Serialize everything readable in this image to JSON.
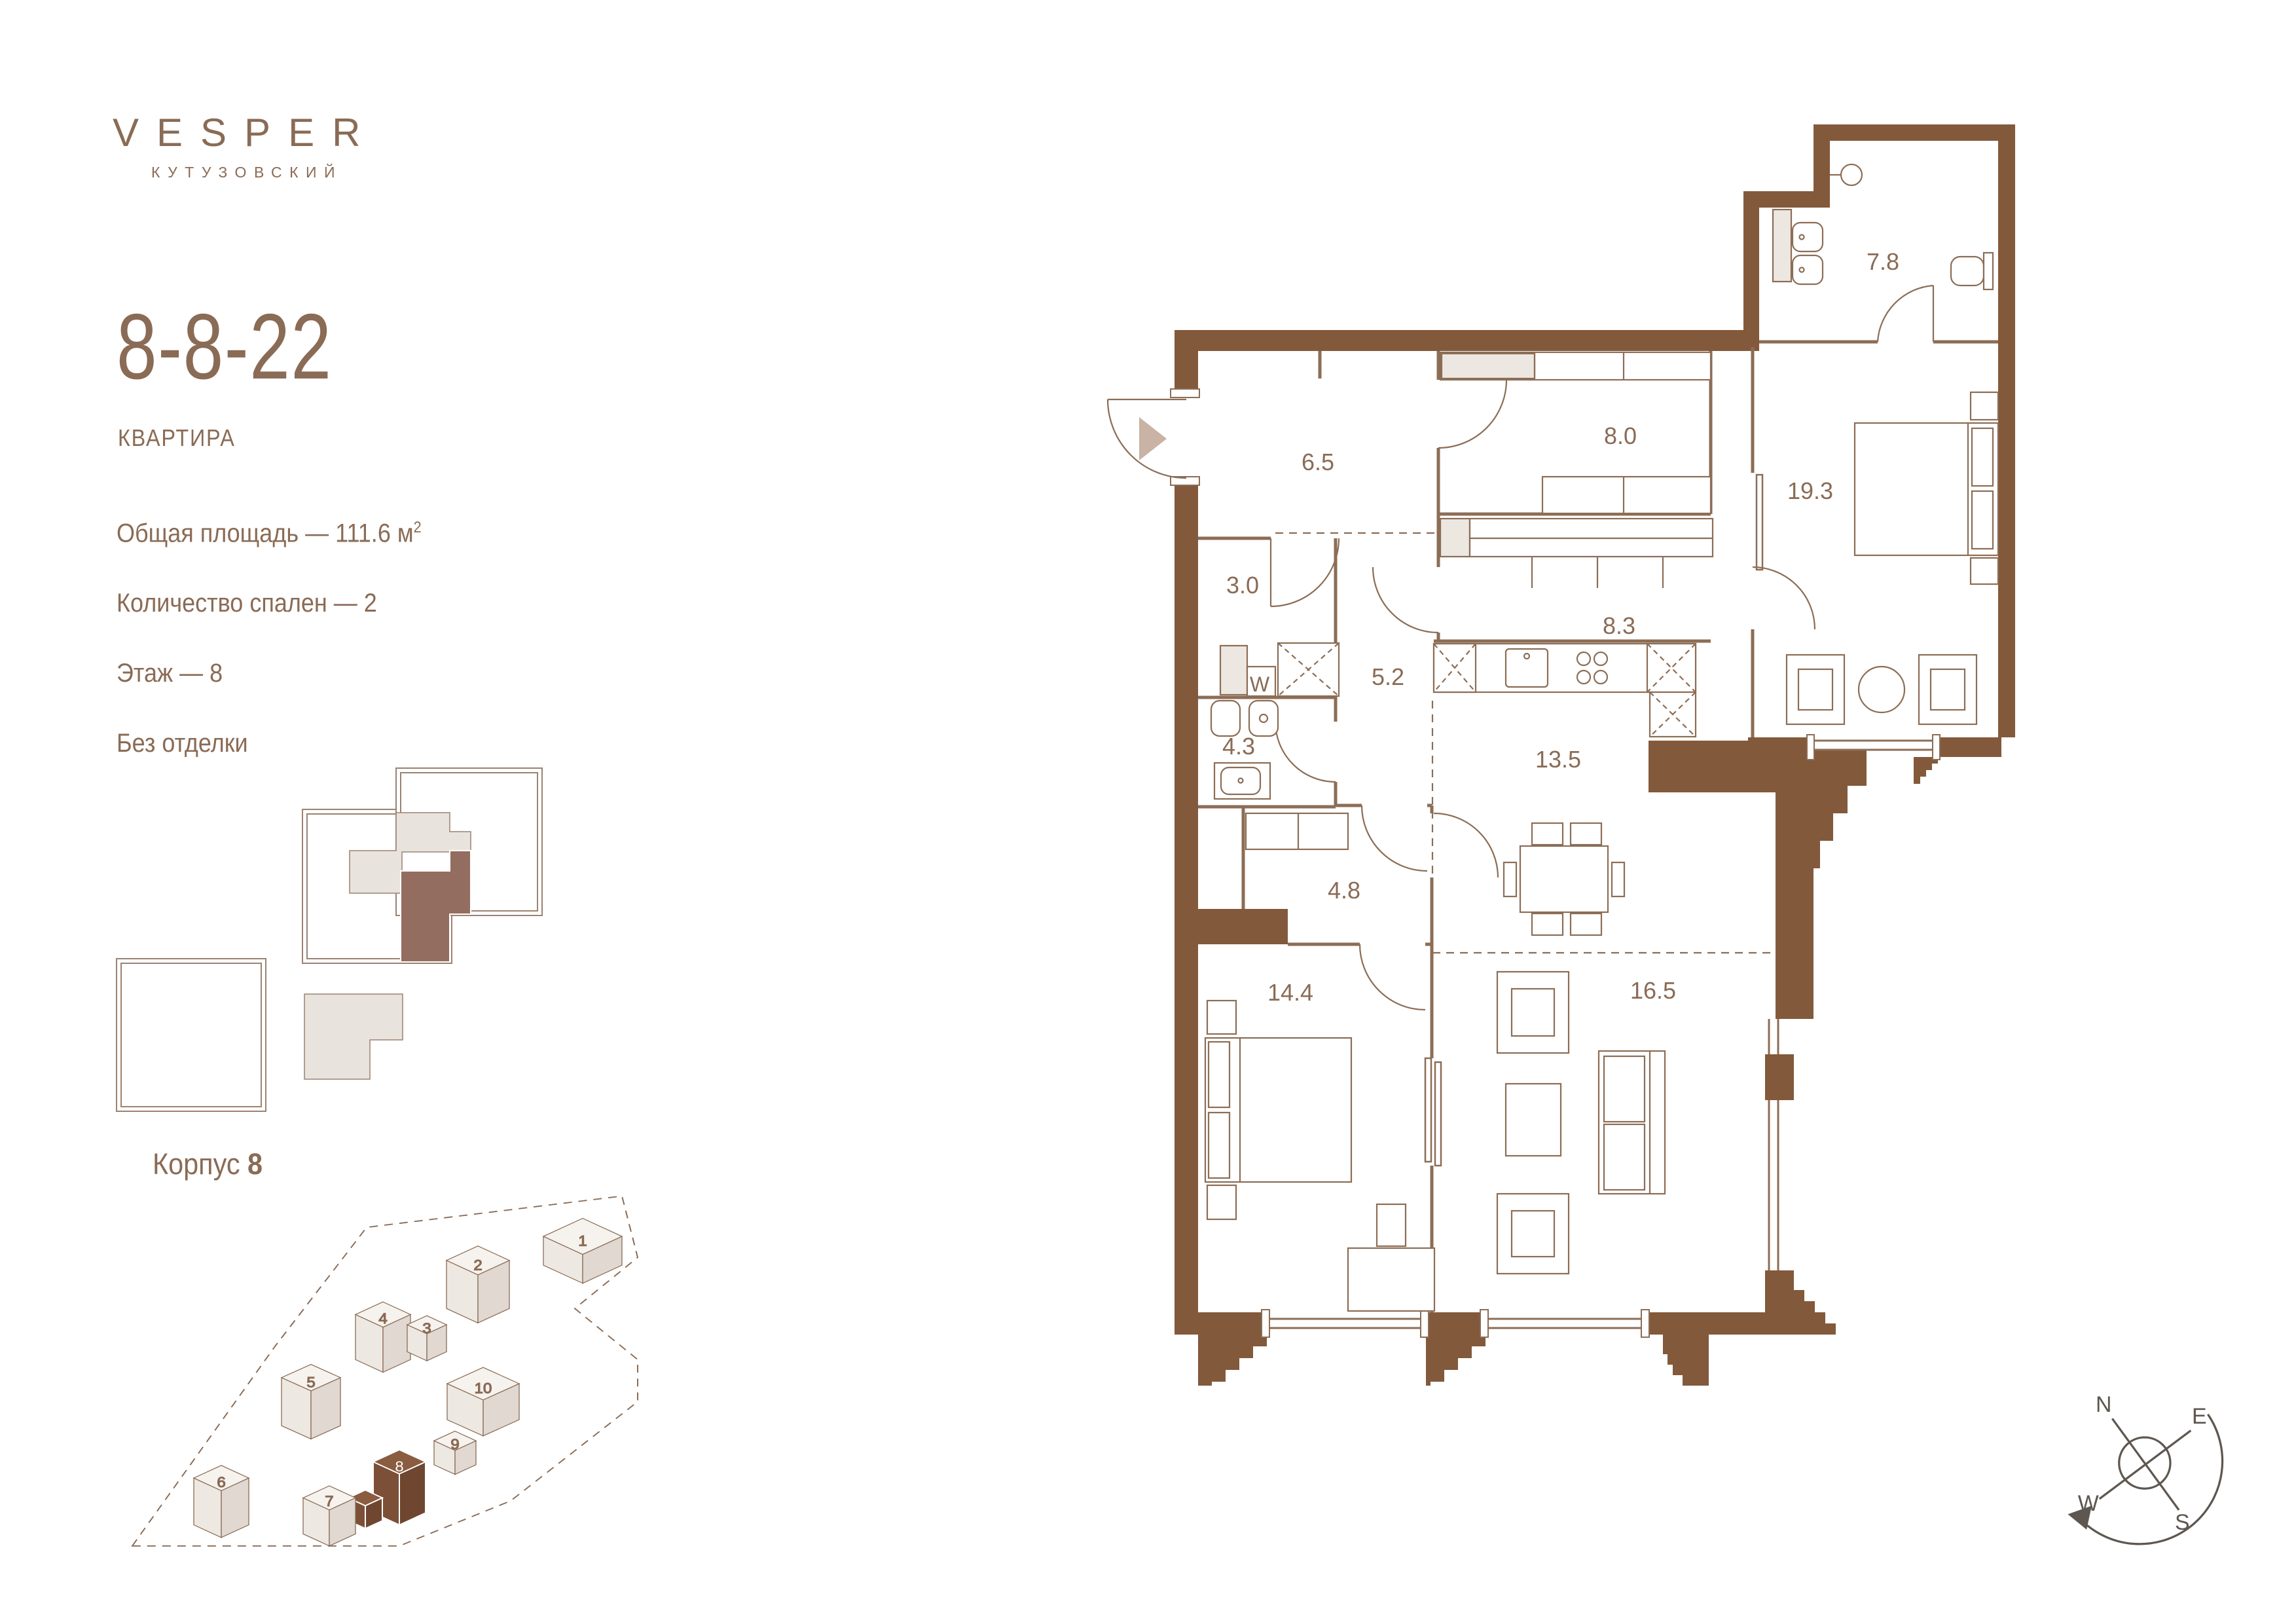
{
  "brand": {
    "name": "VESPER",
    "subtitle": "КУТУЗОВСКИЙ"
  },
  "apartment": {
    "number": "8-8-22",
    "type_label": "КВАРТИРА"
  },
  "details": {
    "area_text": "Общая площадь — 111.6 м",
    "area_sup": "2",
    "bedrooms_text": "Количество спален — 2",
    "floor_text": "Этаж — 8",
    "finish_text": "Без отделки"
  },
  "building_block": {
    "label": "Корпус",
    "number": "8"
  },
  "site_plan": {
    "buildings": [
      {
        "number": "1"
      },
      {
        "number": "2"
      },
      {
        "number": "3"
      },
      {
        "number": "4"
      },
      {
        "number": "5"
      },
      {
        "number": "6"
      },
      {
        "number": "7"
      },
      {
        "number": "8"
      },
      {
        "number": "9"
      },
      {
        "number": "10"
      }
    ]
  },
  "floor_plan": {
    "washer_label": "W",
    "rooms": [
      {
        "name": "hallway",
        "area": "6.5"
      },
      {
        "name": "laundry",
        "area": "3.0"
      },
      {
        "name": "bathroom",
        "area": "4.3"
      },
      {
        "name": "corridor",
        "area": "5.2"
      },
      {
        "name": "wardrobe",
        "area": "8.0"
      },
      {
        "name": "corridor-wardrobe",
        "area": "8.3"
      },
      {
        "name": "bathroom-master",
        "area": "7.8"
      },
      {
        "name": "bedroom-master",
        "area": "19.3"
      },
      {
        "name": "kitchen-dining",
        "area": "13.5"
      },
      {
        "name": "hall",
        "area": "4.8"
      },
      {
        "name": "bedroom",
        "area": "14.4"
      },
      {
        "name": "living-room",
        "area": "16.5"
      }
    ]
  },
  "compass": {
    "north": "N",
    "east": "E",
    "south": "S",
    "west": "W"
  },
  "colors": {
    "brand": "#8A6B55",
    "wall": "#83593B",
    "line": "#8C6D55",
    "beige": "#E9E3DD",
    "highlight": "#936E60",
    "site_building": "#7C5036"
  }
}
